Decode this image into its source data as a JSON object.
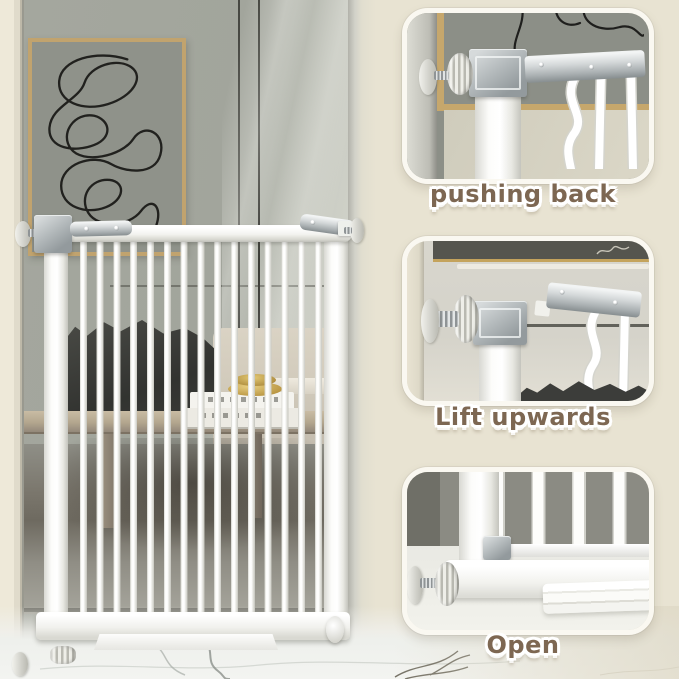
{
  "image": {
    "kind": "product instruction photo",
    "subject": "white metal walk-through baby safety gate installed in a doorway"
  },
  "colors": {
    "background": "#e8e3d2",
    "caption_text": "#7d6752",
    "caption_outline": "#ffffff",
    "panel_border": "#faf8f1",
    "gate_white": "#ffffff",
    "metal_gray": "#b4babc",
    "wall_gray": "#a2a59c",
    "frame_tan": "#c1a36e",
    "marble": "#f0f1ee"
  },
  "steps": [
    {
      "caption": "pushing back"
    },
    {
      "caption": "Lift upwards"
    },
    {
      "caption": "Open"
    }
  ]
}
